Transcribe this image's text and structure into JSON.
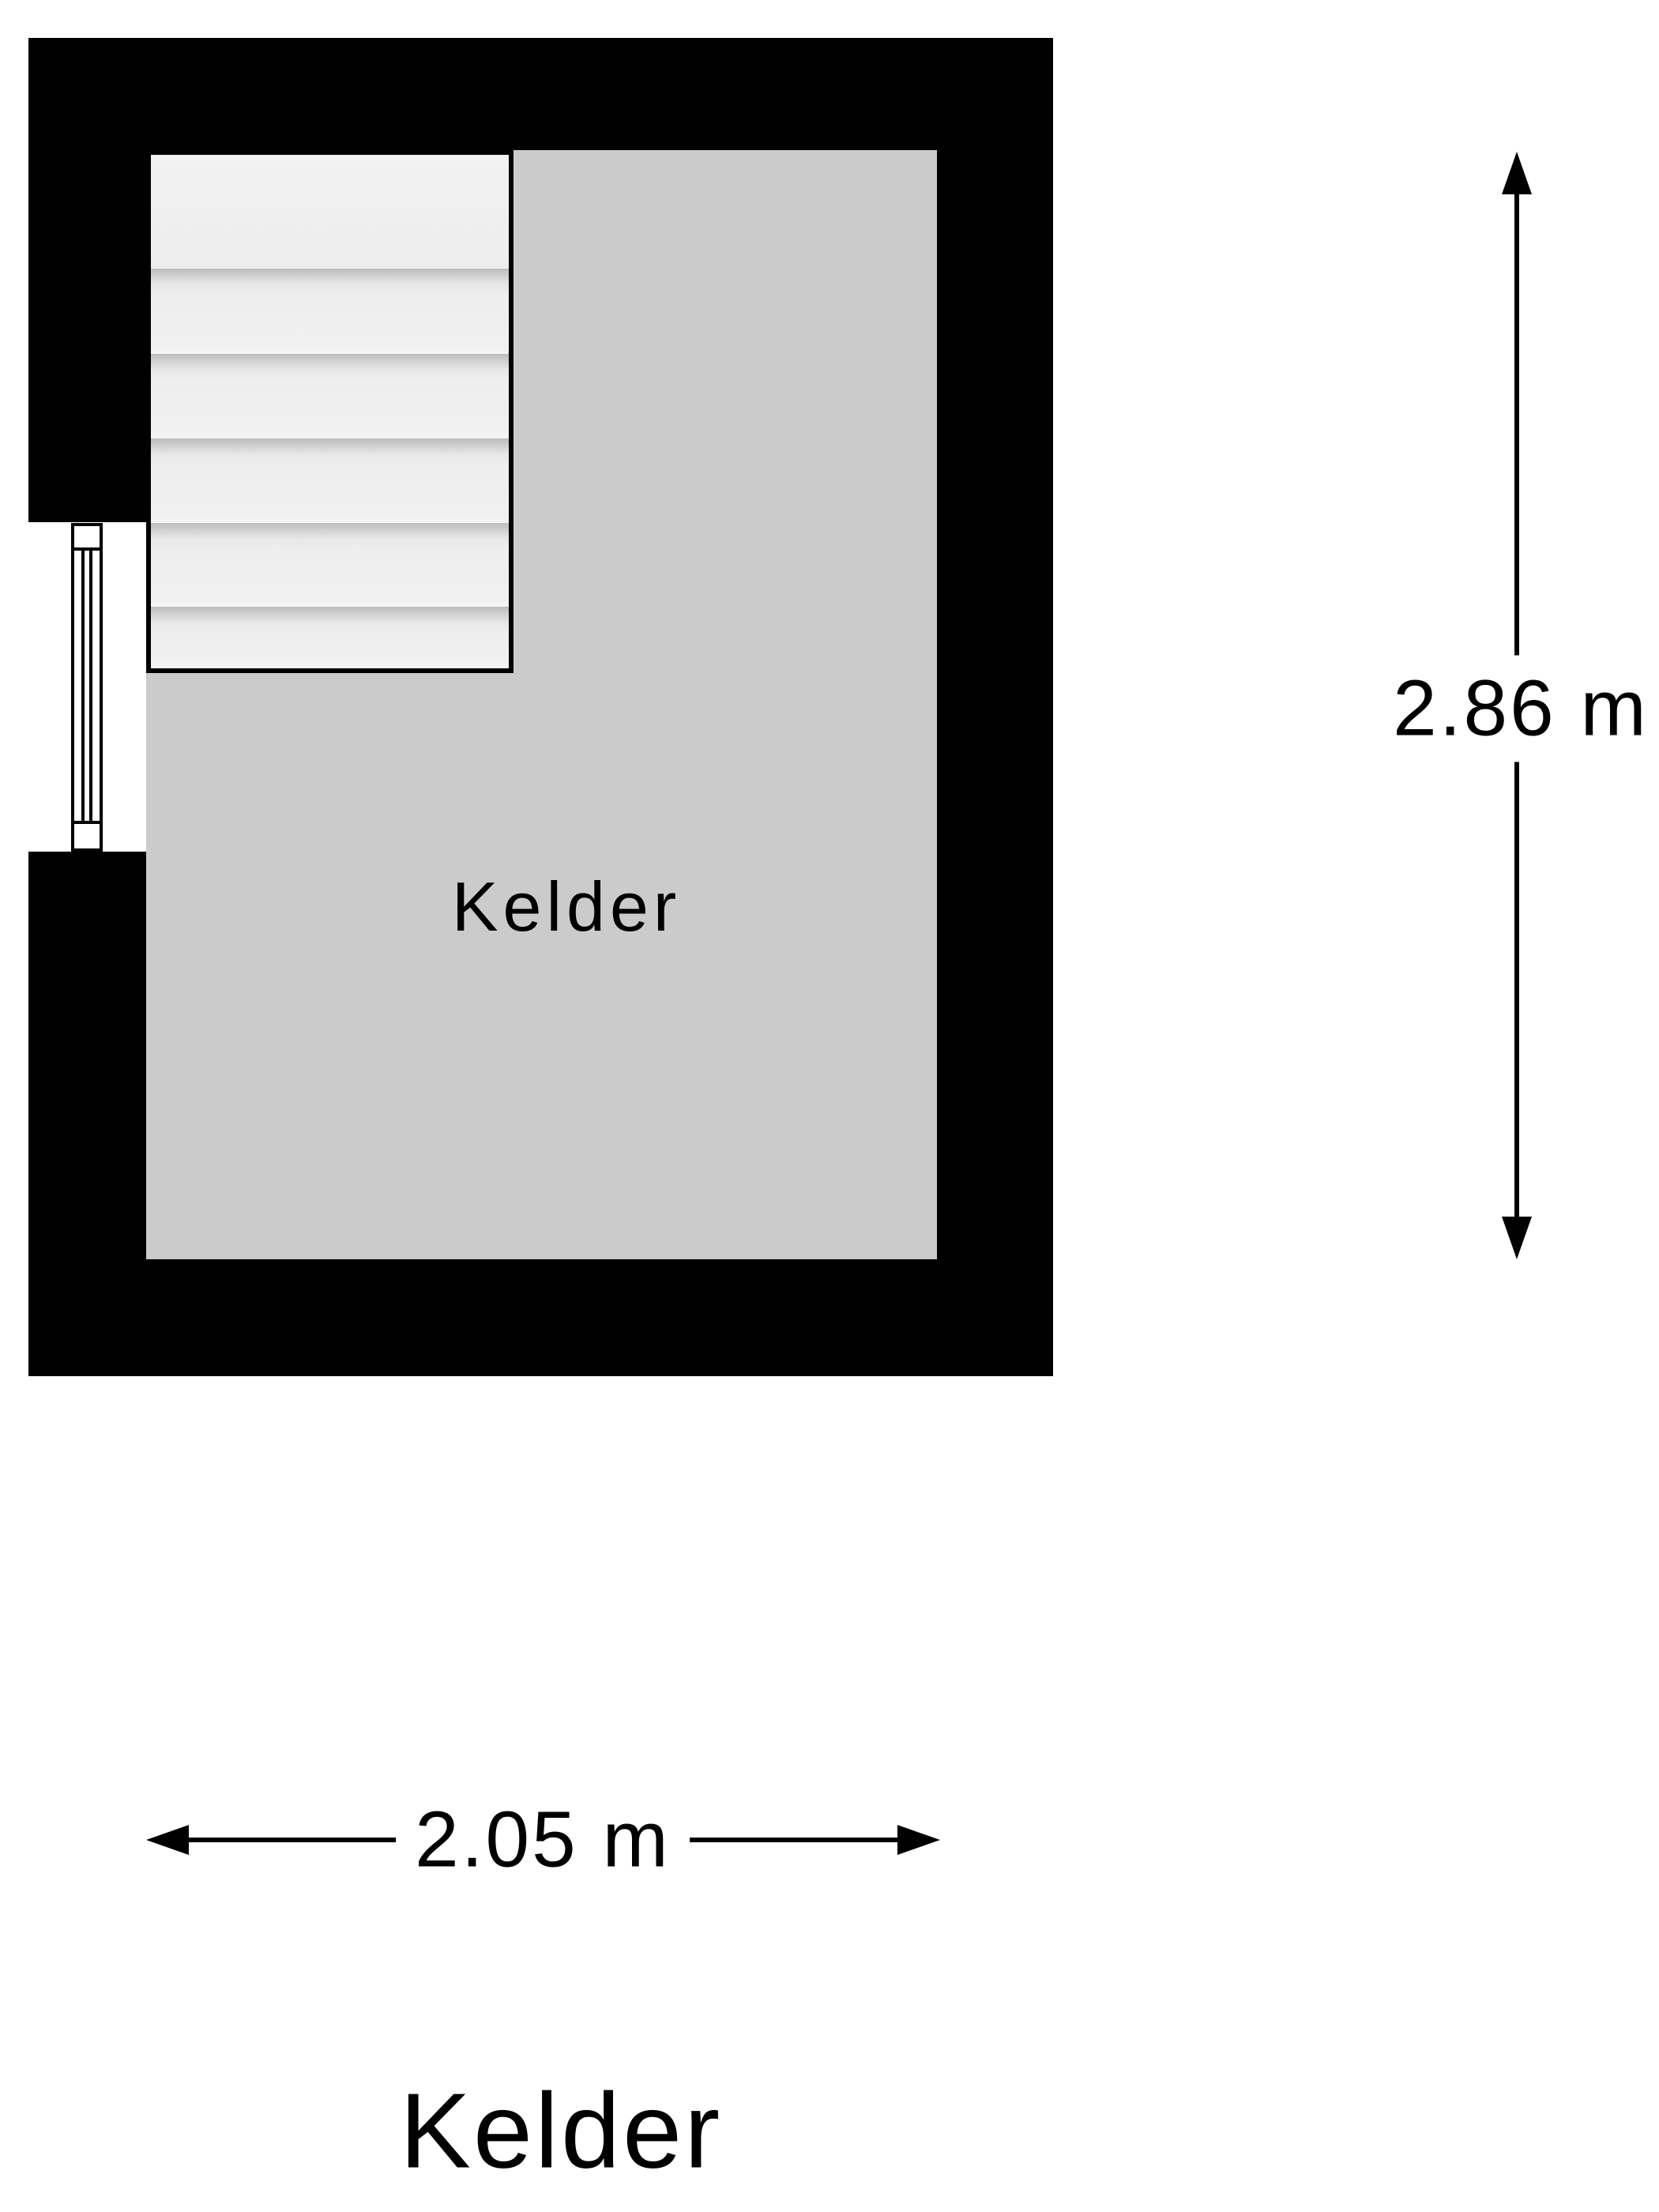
{
  "floorplan": {
    "room_label": "Kelder",
    "plan_title": "Kelder",
    "dimensions": {
      "vertical_label": "2.86 m",
      "vertical_value_m": 2.86,
      "horizontal_label": "2.05 m",
      "horizontal_value_m": 2.05
    },
    "stairs": {
      "tread_count": 6
    },
    "colors": {
      "wall": "#000000",
      "room_fill": "#cbcbcb",
      "stair_fill": "#efefef",
      "stair_shadow": "#bdbdbd",
      "background": "#ffffff",
      "text": "#000000"
    }
  }
}
